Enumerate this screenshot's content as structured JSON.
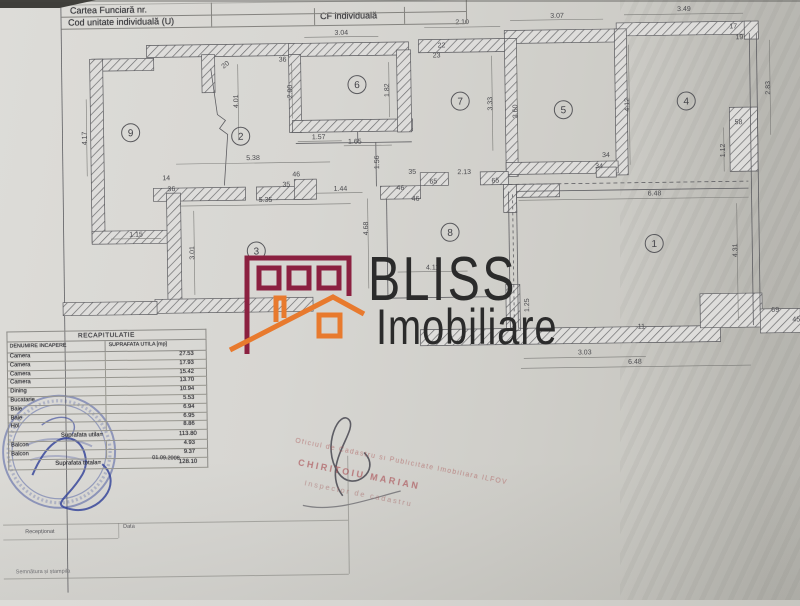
{
  "header": {
    "row1_label": "Cartea Funciară nr.",
    "row2_label": "Cod unitate individuală (U)",
    "cf_label": "CF individuală"
  },
  "watermark": {
    "brand": "BLISS",
    "brand2": "Imobiliare",
    "brand_color": "#2b2b2b",
    "logo_maroon": "#8b2040",
    "logo_orange": "#e87a2e"
  },
  "plan": {
    "rooms": [
      {
        "n": "9",
        "x": 133,
        "y": 129
      },
      {
        "n": "2",
        "x": 243,
        "y": 134
      },
      {
        "n": "6",
        "x": 360,
        "y": 84
      },
      {
        "n": "7",
        "x": 463,
        "y": 102
      },
      {
        "n": "5",
        "x": 566,
        "y": 112
      },
      {
        "n": "4",
        "x": 689,
        "y": 105
      },
      {
        "n": "3",
        "x": 257,
        "y": 249
      },
      {
        "n": "8",
        "x": 451,
        "y": 233
      },
      {
        "n": "1",
        "x": 655,
        "y": 247
      }
    ],
    "dims": [
      {
        "t": "3.04",
        "x": 345,
        "y": 34
      },
      {
        "t": "2.10",
        "x": 466,
        "y": 25
      },
      {
        "t": "3.07",
        "x": 561,
        "y": 20
      },
      {
        "t": "3.49",
        "x": 688,
        "y": 15
      },
      {
        "t": "36",
        "x": 286,
        "y": 60
      },
      {
        "t": "20",
        "x": 230,
        "y": 64,
        "r": -38
      },
      {
        "t": "22",
        "x": 445,
        "y": 48
      },
      {
        "t": "23",
        "x": 440,
        "y": 58
      },
      {
        "t": "17",
        "x": 737,
        "y": 33
      },
      {
        "t": "19",
        "x": 743,
        "y": 44
      },
      {
        "t": "1.82",
        "x": 392,
        "y": 90,
        "r": -90
      },
      {
        "t": "2.00",
        "x": 295,
        "y": 90,
        "r": -90
      },
      {
        "t": "4.01",
        "x": 241,
        "y": 99,
        "r": -90
      },
      {
        "t": "4.17",
        "x": 89,
        "y": 134,
        "r": -90
      },
      {
        "t": "3.33",
        "x": 495,
        "y": 105,
        "r": -90
      },
      {
        "t": "3.60",
        "x": 520,
        "y": 113,
        "r": -90
      },
      {
        "t": "4.12",
        "x": 632,
        "y": 108,
        "r": -90
      },
      {
        "t": "2.83",
        "x": 773,
        "y": 93,
        "r": -90
      },
      {
        "t": "58",
        "x": 741,
        "y": 129
      },
      {
        "t": "1.12",
        "x": 727,
        "y": 155,
        "r": -90
      },
      {
        "t": "1.57",
        "x": 321,
        "y": 138
      },
      {
        "t": "1.65",
        "x": 357,
        "y": 143
      },
      {
        "t": "1.56",
        "x": 381,
        "y": 162,
        "r": -90
      },
      {
        "t": "5.38",
        "x": 255,
        "y": 158
      },
      {
        "t": "46",
        "x": 298,
        "y": 175
      },
      {
        "t": "35",
        "x": 288,
        "y": 185
      },
      {
        "t": "1.44",
        "x": 342,
        "y": 190
      },
      {
        "t": "14",
        "x": 168,
        "y": 177
      },
      {
        "t": "36",
        "x": 173,
        "y": 188
      },
      {
        "t": "35",
        "x": 414,
        "y": 174
      },
      {
        "t": "65",
        "x": 435,
        "y": 184
      },
      {
        "t": "2.13",
        "x": 466,
        "y": 175
      },
      {
        "t": "65",
        "x": 497,
        "y": 184
      },
      {
        "t": "34",
        "x": 608,
        "y": 160
      },
      {
        "t": "34",
        "x": 601,
        "y": 171
      },
      {
        "t": "5.35",
        "x": 267,
        "y": 200
      },
      {
        "t": "46",
        "x": 402,
        "y": 190
      },
      {
        "t": "46",
        "x": 417,
        "y": 201
      },
      {
        "t": "4.68",
        "x": 369,
        "y": 228,
        "r": -90
      },
      {
        "t": "3.01",
        "x": 195,
        "y": 250,
        "r": -90
      },
      {
        "t": "6.48",
        "x": 656,
        "y": 199
      },
      {
        "t": "4.31",
        "x": 738,
        "y": 255,
        "r": -90
      },
      {
        "t": "1.15",
        "x": 137,
        "y": 233
      },
      {
        "t": "4.11",
        "x": 433,
        "y": 270
      },
      {
        "t": "1.25",
        "x": 529,
        "y": 307,
        "r": -90
      },
      {
        "t": "11",
        "x": 641,
        "y": 332
      },
      {
        "t": "3.03",
        "x": 584,
        "y": 357
      },
      {
        "t": "6.48",
        "x": 634,
        "y": 367
      },
      {
        "t": "69",
        "x": 775,
        "y": 317
      },
      {
        "t": "45",
        "x": 796,
        "y": 327
      }
    ]
  },
  "recap": {
    "title": "RECAPITULATIE",
    "col1": "DENUMIRE INCAPERE",
    "col2": "SUPRAFATA UTILA [mp]",
    "rows": [
      {
        "name": "Camera",
        "value": "27.53"
      },
      {
        "name": "Camera",
        "value": "17.93"
      },
      {
        "name": "Camera",
        "value": "15.42"
      },
      {
        "name": "Camera",
        "value": "13.70"
      },
      {
        "name": "Dining",
        "value": "10.94"
      },
      {
        "name": "Bucatarie",
        "value": "5.53"
      },
      {
        "name": "Baie",
        "value": "6.94"
      },
      {
        "name": "Baie",
        "value": "6.95"
      },
      {
        "name": "Hol",
        "value": "8.86"
      }
    ],
    "subtotal_label": "Suprafata utila=",
    "subtotal_value": "113.80",
    "extra_rows": [
      {
        "name": "Balcon",
        "value": "4.93"
      },
      {
        "name": "Balcon",
        "value": "9.37"
      }
    ],
    "total_label": "Suprafata totala=",
    "total_value": "128.10",
    "date": "01.09.2008"
  },
  "footer": {
    "received_label": "Recepționat",
    "date_label": "Data",
    "signature_label": "Semnătura și ștampila"
  },
  "cadastre_stamp": {
    "line1": "Oficiul de Cadastru si Publicitate Imobiliara ILFOV",
    "line2": "CHIRITOIU MARIAN",
    "line3": "Inspector de cadastru"
  }
}
